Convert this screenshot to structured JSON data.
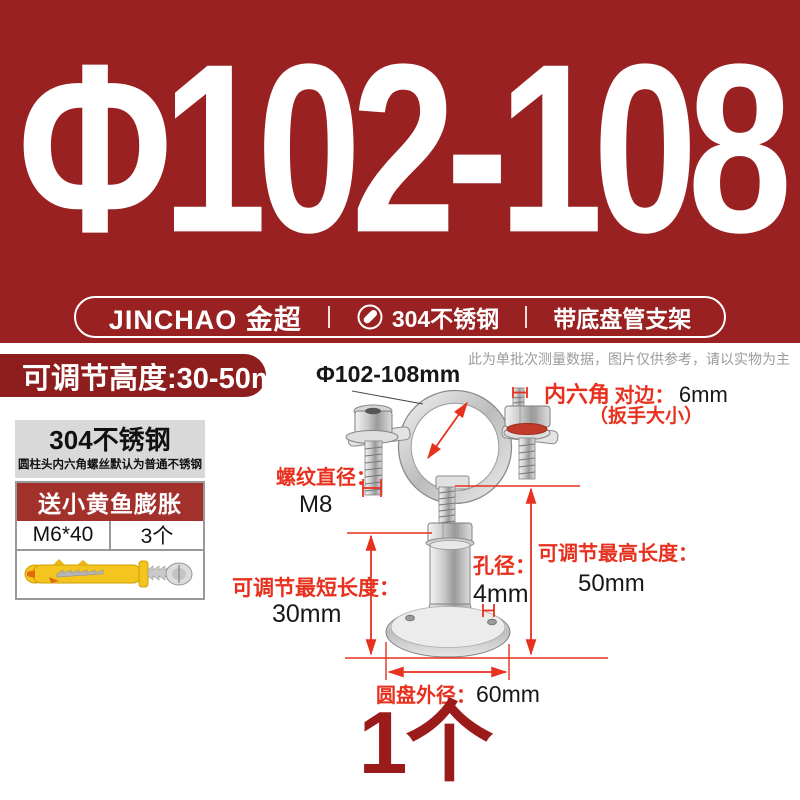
{
  "colors": {
    "hero_background": "#9a2121",
    "pill_red": "#8e1d1d",
    "gift_header_red": "#a2302b",
    "quantity_red": "#9b1b1b",
    "annotation_red": "#e8301e",
    "material_box_gray": "#d9d9d9"
  },
  "hero": {
    "title": "Φ102-108",
    "banner": {
      "brand": "JINCHAO 金超",
      "material": "304不锈钢",
      "product": "带底盘管支架"
    }
  },
  "highlight_pill": "可调节高度:30-50mm",
  "disclaimer": "此为单批次测量数据，图片仅供参考，请以实物为主",
  "side_panel": {
    "material_title": "304不锈钢",
    "material_note": "圆柱头内六角螺丝默认为普通不锈钢",
    "gift_title": "送小黄鱼膨胀",
    "gift_spec": "M6*40",
    "gift_qty": "3个"
  },
  "annotations": {
    "diameter": "Φ102-108mm",
    "hex_label": "内六角",
    "hex_side": "对边：",
    "hex_value": "6mm",
    "hex_note": "（扳手大小）",
    "thread_label": "螺纹直径：",
    "thread_value": "M8",
    "max_label": "可调节最高长度：",
    "max_value": "50mm",
    "min_label": "可调节最短长度：",
    "min_value": "30mm",
    "hole_label": "孔径：",
    "hole_value": "4mm",
    "disc_label": "圆盘外径：",
    "disc_value": "60mm"
  },
  "quantity": "1个"
}
